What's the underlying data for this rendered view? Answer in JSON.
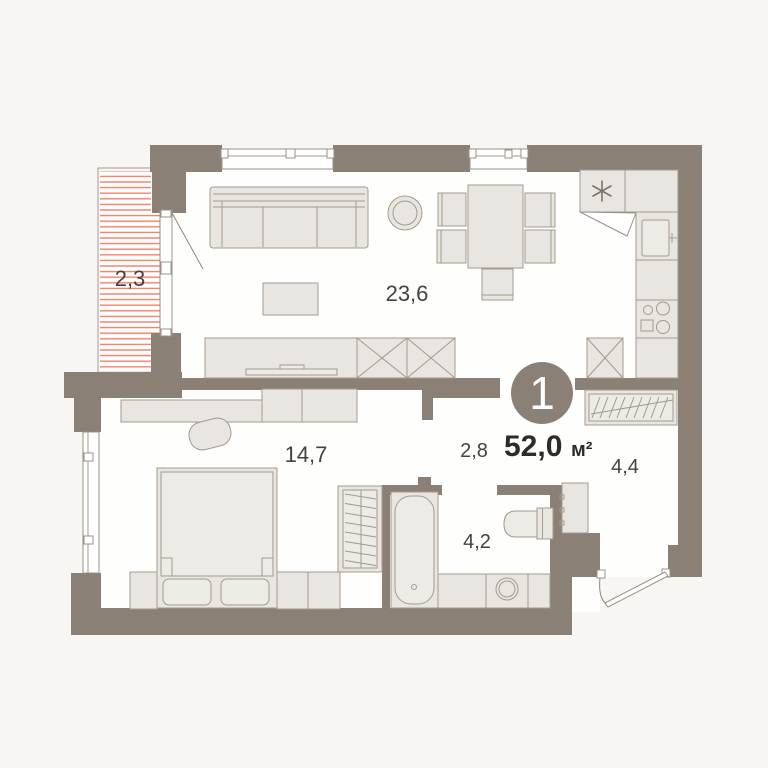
{
  "plan": {
    "badge": {
      "rooms_count": "1"
    },
    "total_area": {
      "value": "52,0",
      "unit": "м²"
    },
    "areas": {
      "balcony": "2,3",
      "living_kitchen": "23,6",
      "bedroom": "14,7",
      "hall": "2,8",
      "bathroom": "4,2",
      "corridor": "4,4"
    },
    "icons": {
      "ventilation": "asterisk",
      "fridge": "crossed-box",
      "wardrobe_living": "crossed-box",
      "closet_hangers": "slant-hatch"
    },
    "colors": {
      "wall": "#8b8076",
      "floor": "#fefefd",
      "background": "#f7f6f3",
      "furniture_fill": "#e9e5e0",
      "furniture_stroke": "#a39a8e",
      "balcony_stripe": "#ef8066",
      "area_label_text": "#45423f",
      "total_text": "#2e2c2a",
      "badge_text": "#ffffff"
    }
  }
}
